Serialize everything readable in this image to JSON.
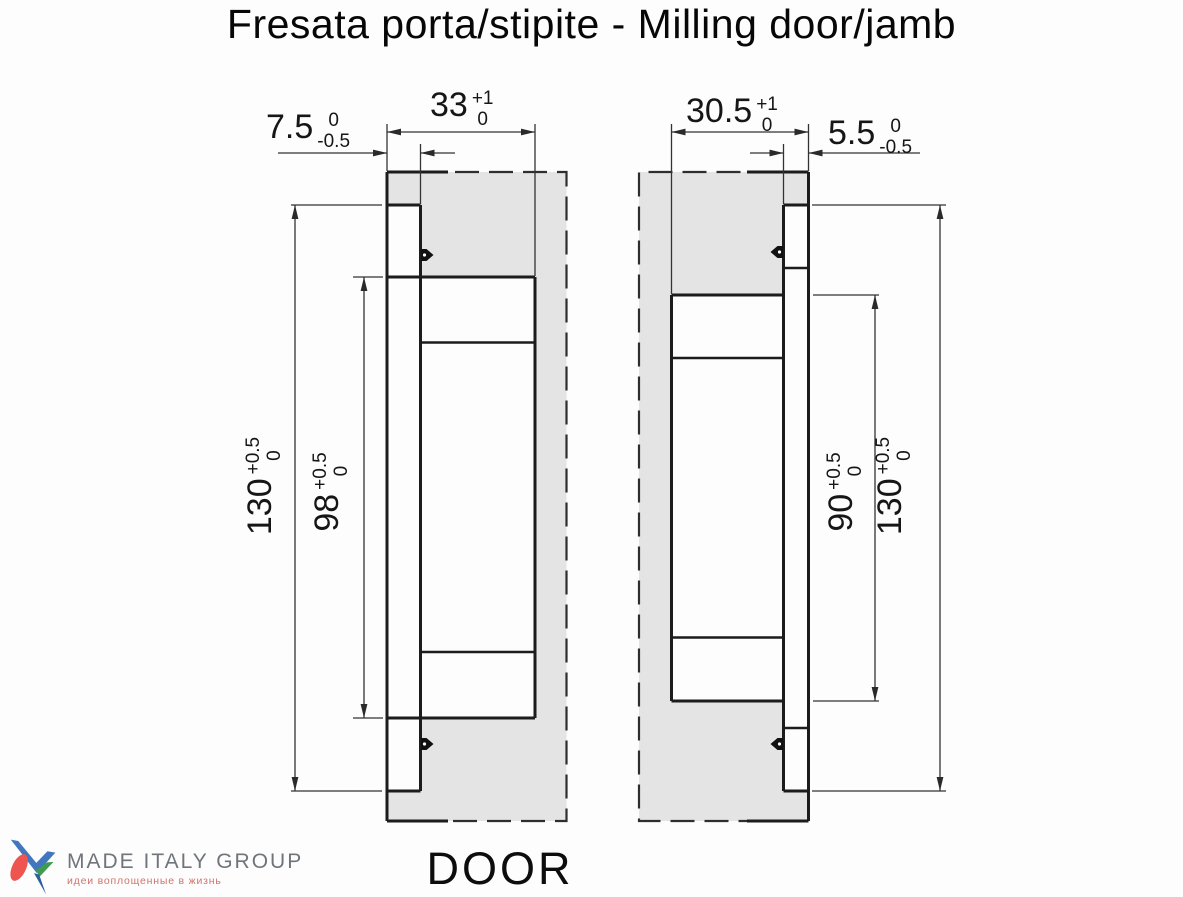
{
  "title": "Fresata porta/stipite - Milling door/jamb",
  "footer": {
    "door_label": "DOOR"
  },
  "logo": {
    "name": "MADE ITALY GROUP",
    "tagline": "идеи воплощенные в жизнь",
    "mark_colors": {
      "blue": "#4077be",
      "dark_blue": "#2c5d9e",
      "red": "#ee5450",
      "green": "#3f9b4e"
    }
  },
  "drawings": {
    "door": {
      "dims": {
        "edge_offset": {
          "value": "7.5",
          "tol_upper": "0",
          "tol_lower": "-0.5"
        },
        "pocket_depth": {
          "value": "33",
          "tol_upper": "+1",
          "tol_lower": "0"
        },
        "outer_length": {
          "value": "130",
          "tol_upper": "+0.5",
          "tol_lower": "0"
        },
        "pocket_length": {
          "value": "98",
          "tol_upper": "+0.5",
          "tol_lower": "0"
        }
      }
    },
    "jamb": {
      "dims": {
        "pocket_depth": {
          "value": "30.5",
          "tol_upper": "+1",
          "tol_lower": "0"
        },
        "edge_offset": {
          "value": "5.5",
          "tol_upper": "0",
          "tol_lower": "-0.5"
        },
        "pocket_length": {
          "value": "90",
          "tol_upper": "+0.5",
          "tol_lower": "0"
        },
        "outer_length": {
          "value": "130",
          "tol_upper": "+0.5",
          "tol_lower": "0"
        }
      }
    }
  },
  "colors": {
    "material_fill": "#e4e4e5",
    "profile_line": "#1c1c1c",
    "dimension_line": "#333333",
    "logo_text_gray": "#6f757a",
    "logo_tagline_red": "#d0736c"
  }
}
